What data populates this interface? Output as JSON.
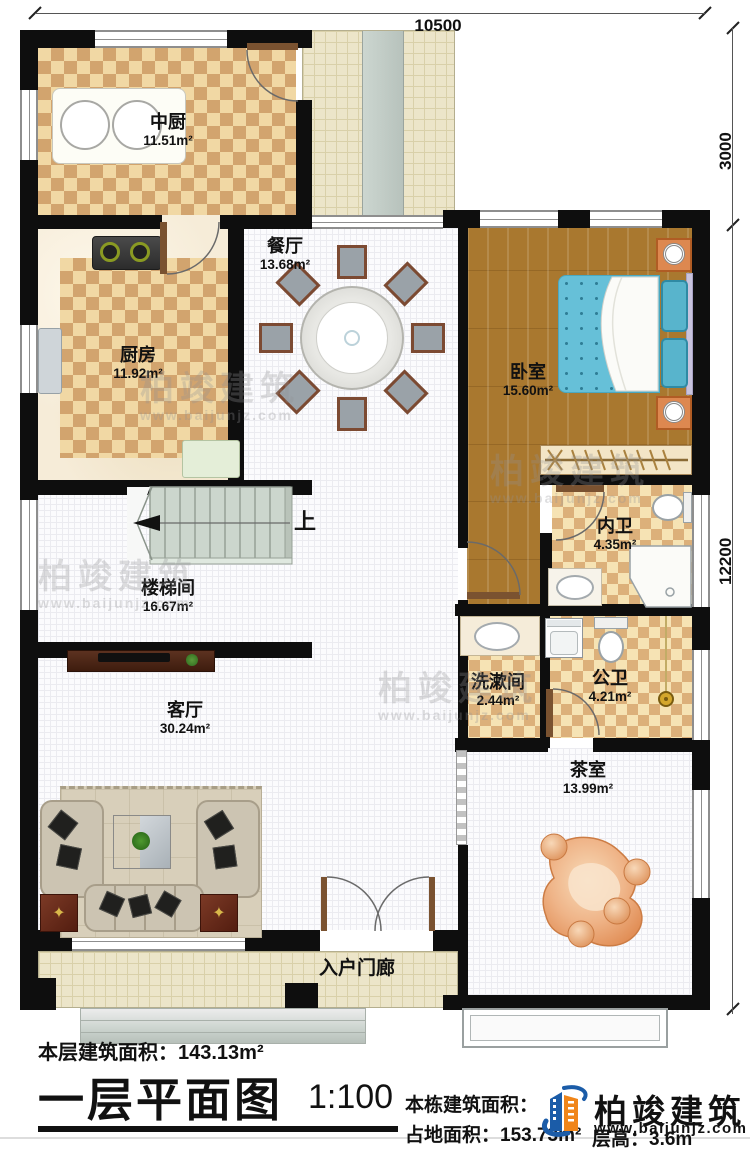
{
  "dimensions": {
    "top": "10500",
    "right_upper": "3000",
    "right_lower": "12200"
  },
  "rooms": {
    "zhongchu": {
      "name": "中厨",
      "area": "11.51m²"
    },
    "canting": {
      "name": "餐厅",
      "area": "13.68m²"
    },
    "chufang": {
      "name": "厨房",
      "area": "11.92m²"
    },
    "woshi": {
      "name": "卧室",
      "area": "15.60m²"
    },
    "neiwei": {
      "name": "内卫",
      "area": "4.35m²"
    },
    "loutijian": {
      "name": "楼梯间",
      "area": "16.67m²"
    },
    "xishujian": {
      "name": "洗漱间",
      "area": "2.44m²"
    },
    "gongwei": {
      "name": "公卫",
      "area": "4.21m²"
    },
    "keting": {
      "name": "客厅",
      "area": "30.24m²"
    },
    "chashi": {
      "name": "茶室",
      "area": "13.99m²"
    },
    "rumenlang": {
      "name": "入户门廊"
    }
  },
  "stairs": {
    "up_label": "上"
  },
  "title_block": {
    "floor_area_label": "本层建筑面积：",
    "floor_area_value": "143.13m²",
    "title": "一层平面图",
    "scale": "1:100",
    "building_area_label": "本栋建筑面积：",
    "land_area_label": "占地面积：",
    "land_area_value": "153.73m²",
    "floor_height_label": "层高：",
    "floor_height_value": "3.6m"
  },
  "logo": {
    "name": "柏竣建筑",
    "url": "www.baijunjz.com"
  },
  "watermark": {
    "name": "柏竣建筑",
    "url": "www.baijunjz.com"
  }
}
